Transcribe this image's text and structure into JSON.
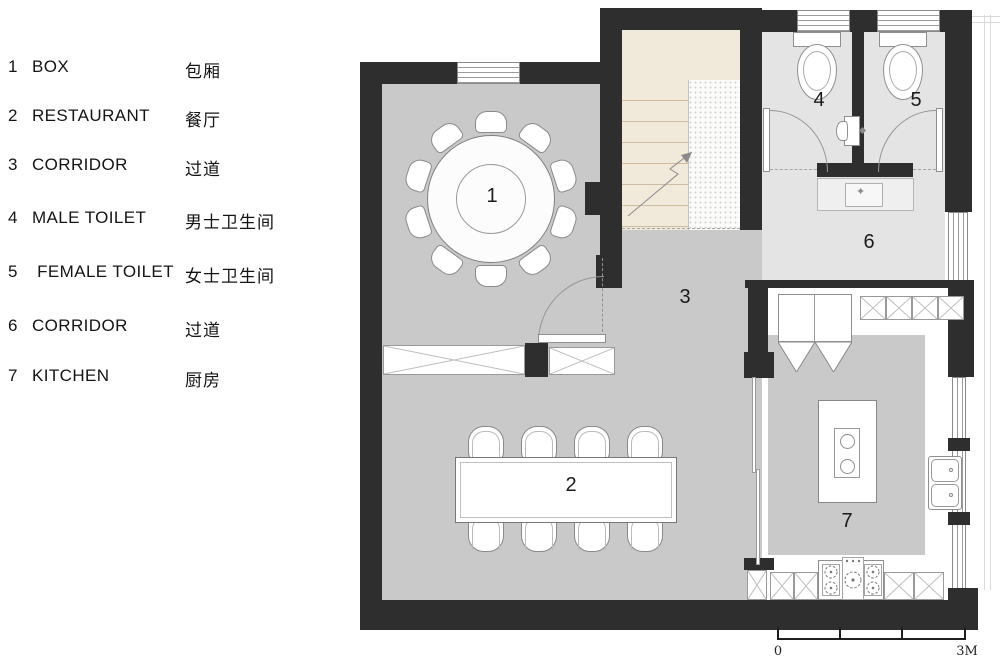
{
  "legend": {
    "items": [
      {
        "num": "1",
        "en": "BOX",
        "zh": "包厢"
      },
      {
        "num": "2",
        "en": "RESTAURANT",
        "zh": "餐厅"
      },
      {
        "num": "3",
        "en": "CORRIDOR",
        "zh": "过道"
      },
      {
        "num": "4",
        "en": "MALE TOILET",
        "zh": "男士卫生间"
      },
      {
        "num": "5",
        "en": "FEMALE TOILET",
        "zh": "女士卫生间"
      },
      {
        "num": "6",
        "en": "CORRIDOR",
        "zh": "过道"
      },
      {
        "num": "7",
        "en": "KITCHEN",
        "zh": "厨房"
      }
    ]
  },
  "plan": {
    "room_labels": [
      "1",
      "2",
      "3",
      "4",
      "5",
      "6",
      "7"
    ]
  },
  "scale_bar": {
    "zero": "0",
    "max": "3M"
  },
  "colors": {
    "wall": "#2e2e2e",
    "floor_main": "#c9c9c9",
    "floor_light": "#e4e4e4",
    "floor_stairs": "#f1e9da",
    "line": "#8a8a8a"
  }
}
